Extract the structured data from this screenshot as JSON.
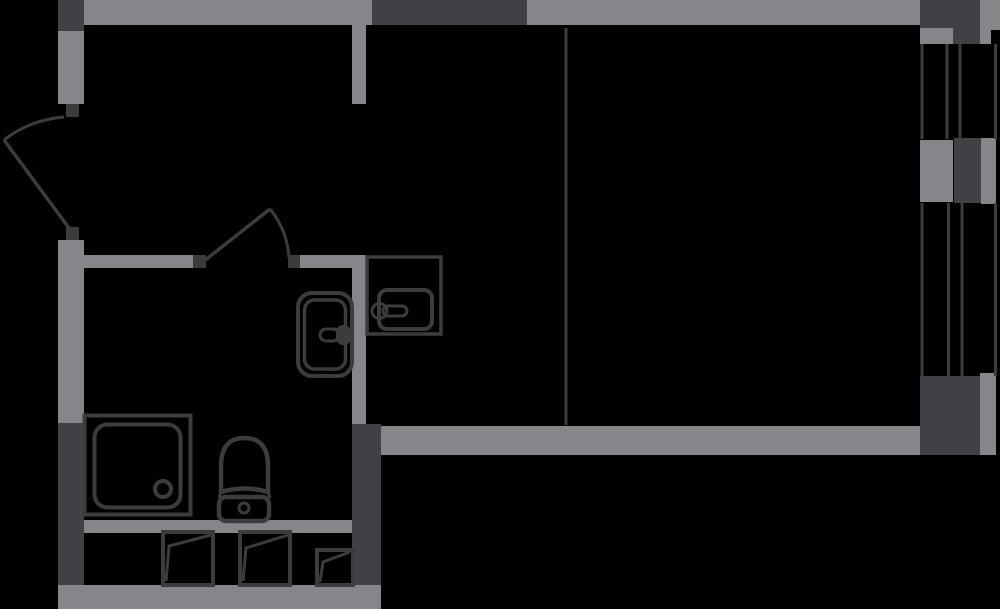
{
  "canvas": {
    "width": 1000,
    "height": 609,
    "background": "#000000"
  },
  "colors": {
    "wall": "#84868A",
    "column": "#404144",
    "line": "#3B3C3E"
  },
  "plan": {
    "walls": [
      {
        "name": "top-exterior-wall",
        "x": 84,
        "y": 0,
        "w": 836,
        "h": 25
      },
      {
        "name": "left-wall-upper",
        "x": 58,
        "y": 31,
        "w": 26,
        "h": 73
      },
      {
        "name": "left-wall-middle",
        "x": 58,
        "y": 240,
        "w": 26,
        "h": 183
      },
      {
        "name": "bath-top-wall-left",
        "x": 84,
        "y": 255,
        "w": 109,
        "h": 13
      },
      {
        "name": "bath-top-wall-right",
        "x": 300,
        "y": 255,
        "w": 66,
        "h": 13
      },
      {
        "name": "divider-wall-stub",
        "x": 352,
        "y": 25,
        "w": 14,
        "h": 79
      },
      {
        "name": "divider-wall",
        "x": 352,
        "y": 255,
        "w": 14,
        "h": 170
      },
      {
        "name": "bath-bottom-wall",
        "x": 84,
        "y": 520,
        "w": 268,
        "h": 13
      },
      {
        "name": "bottom-exterior-wall",
        "x": 58,
        "y": 585,
        "w": 323,
        "h": 24
      },
      {
        "name": "living-bottom-wall",
        "x": 381,
        "y": 426,
        "w": 539,
        "h": 29
      },
      {
        "name": "window-sill-top",
        "x": 920,
        "y": 28,
        "w": 33,
        "h": 16
      },
      {
        "name": "window-pillar-sill",
        "x": 920,
        "y": 140,
        "w": 33,
        "h": 62
      },
      {
        "name": "right-outer-wall-top",
        "x": 980,
        "y": 0,
        "w": 20,
        "h": 44
      },
      {
        "name": "right-outer-wall-mid",
        "x": 981,
        "y": 138,
        "w": 15,
        "h": 66
      },
      {
        "name": "right-outer-wall-bottom",
        "x": 980,
        "y": 373,
        "w": 16,
        "h": 82
      }
    ],
    "columns": [
      {
        "name": "corner-column-topleft",
        "x": 58,
        "y": 0,
        "w": 26,
        "h": 31
      },
      {
        "name": "top-wall-dark-section",
        "x": 372,
        "y": 0,
        "w": 155,
        "h": 25
      },
      {
        "name": "right-column-top-inner",
        "x": 920,
        "y": 0,
        "w": 33,
        "h": 28
      },
      {
        "name": "right-column-top-outer",
        "x": 953,
        "y": 0,
        "w": 27,
        "h": 44
      },
      {
        "name": "right-column-mid",
        "x": 954,
        "y": 138,
        "w": 27,
        "h": 65
      },
      {
        "name": "right-column-bottom",
        "x": 920,
        "y": 376,
        "w": 60,
        "h": 79
      },
      {
        "name": "left-column-bottom",
        "x": 58,
        "y": 423,
        "w": 26,
        "h": 162
      },
      {
        "name": "bath-corner-column",
        "x": 352,
        "y": 424,
        "w": 29,
        "h": 161
      }
    ],
    "notches": [
      {
        "name": "right-outer-notch",
        "x": 991,
        "y": 30,
        "w": 9,
        "h": 14
      }
    ],
    "door_jambs": [
      {
        "name": "entry-door-jamb-top",
        "x": 66,
        "y": 104,
        "w": 13,
        "h": 13
      },
      {
        "name": "entry-door-jamb-bottom",
        "x": 66,
        "y": 227,
        "w": 13,
        "h": 13
      },
      {
        "name": "bath-door-jamb-left",
        "x": 193,
        "y": 255,
        "w": 13,
        "h": 13
      },
      {
        "name": "bath-door-jamb-right",
        "x": 288,
        "y": 255,
        "w": 12,
        "h": 13
      }
    ],
    "partition_lines": [
      {
        "name": "kitchen-partition-line",
        "x": 564.5,
        "y": 28,
        "w": 3,
        "h": 397
      }
    ],
    "window_mullions": [
      {
        "name": "window-line",
        "x": 920.5,
        "y": 44,
        "w": 3,
        "h": 95
      },
      {
        "name": "window-line",
        "x": 945.5,
        "y": 44,
        "w": 3,
        "h": 95
      },
      {
        "name": "window-line",
        "x": 958.5,
        "y": 44,
        "w": 3,
        "h": 95
      },
      {
        "name": "window-line",
        "x": 994,
        "y": 44,
        "w": 3,
        "h": 95
      },
      {
        "name": "window-line",
        "x": 920.5,
        "y": 203,
        "w": 3,
        "h": 173
      },
      {
        "name": "window-line",
        "x": 947,
        "y": 203,
        "w": 3,
        "h": 173
      },
      {
        "name": "window-line",
        "x": 960.5,
        "y": 203,
        "w": 3,
        "h": 173
      },
      {
        "name": "window-line",
        "x": 994,
        "y": 203,
        "w": 3,
        "h": 173
      }
    ],
    "doors": [
      {
        "name": "entry-door",
        "leaf": [
          4,
          140,
          69,
          228
        ],
        "swing_arc": "M 64 117 A 112 112 0 0 0 4 140"
      },
      {
        "name": "bathroom-door",
        "leaf": [
          204,
          261,
          270,
          209
        ],
        "swing_arc": "M 270 209 A 86 86 0 0 1 289 258"
      }
    ],
    "fixtures": [
      {
        "name": "shower-tray",
        "shapes": [
          {
            "t": "rect",
            "x": 84.5,
            "y": 415.5,
            "w": 106,
            "h": 99,
            "sw": 4
          },
          {
            "t": "rect",
            "x": 94.5,
            "y": 424.5,
            "w": 86,
            "h": 83,
            "r": 13,
            "sw": 4
          },
          {
            "t": "circle",
            "cx": 163,
            "cy": 489,
            "r": 8,
            "sw": 4
          }
        ]
      },
      {
        "name": "toilet",
        "shapes": [
          {
            "t": "path",
            "d": "M 221 492 L 221 466 Q 221 438 244.5 438 Q 268 438 268 466 L 268 492 Q 244.5 485 221 492 Z",
            "sw": 4.5
          },
          {
            "t": "line",
            "x1": 222,
            "y1": 489,
            "x2": 219,
            "y2": 498,
            "sw": 3
          },
          {
            "t": "line",
            "x1": 267,
            "y1": 489,
            "x2": 270,
            "y2": 498,
            "sw": 3
          },
          {
            "t": "rect",
            "x": 219,
            "y": 497,
            "w": 50,
            "h": 24,
            "r": 7,
            "sw": 4.5
          },
          {
            "t": "circle",
            "cx": 244,
            "cy": 508,
            "r": 5,
            "sw": 3
          }
        ]
      },
      {
        "name": "washbasin",
        "shapes": [
          {
            "t": "rect",
            "x": 298,
            "y": 293,
            "w": 54,
            "h": 83,
            "r": 14,
            "sw": 4
          },
          {
            "t": "rect",
            "x": 304.5,
            "y": 300,
            "w": 41,
            "h": 69,
            "r": 10,
            "sw": 3.5
          },
          {
            "t": "rect",
            "x": 336,
            "y": 325,
            "w": 15,
            "h": 20,
            "r": 7,
            "f": 1
          },
          {
            "t": "rect",
            "x": 320,
            "y": 329,
            "w": 19,
            "h": 12,
            "r": 6,
            "sw": 3
          }
        ]
      },
      {
        "name": "kitchen-sink",
        "shapes": [
          {
            "t": "rect",
            "x": 367,
            "y": 257,
            "w": 74,
            "h": 77,
            "sw": 3.5
          },
          {
            "t": "rect",
            "x": 379,
            "y": 290,
            "w": 53,
            "h": 39,
            "r": 8,
            "sw": 4
          },
          {
            "t": "circle",
            "cx": 379.5,
            "cy": 311,
            "r": 7.5,
            "sw": 3
          },
          {
            "t": "rect",
            "x": 383,
            "y": 306,
            "w": 24,
            "h": 10,
            "r": 5,
            "sw": 3
          }
        ]
      }
    ],
    "panels": [
      {
        "name": "sash-panel-1",
        "shapes": [
          {
            "t": "rect",
            "x": 163,
            "y": 532,
            "w": 50,
            "h": 53,
            "sw": 4
          },
          {
            "t": "polyline",
            "pts": "211,535 169,546 166,581",
            "sw": 3
          }
        ]
      },
      {
        "name": "sash-panel-2",
        "shapes": [
          {
            "t": "rect",
            "x": 240,
            "y": 532,
            "w": 50,
            "h": 53,
            "sw": 4
          },
          {
            "t": "polyline",
            "pts": "288,535 246,548 243,581",
            "sw": 3
          }
        ]
      },
      {
        "name": "sash-panel-3",
        "shapes": [
          {
            "t": "rect",
            "x": 317,
            "y": 550,
            "w": 36,
            "h": 35,
            "sw": 4
          },
          {
            "t": "polyline",
            "pts": "350,552 323,562 320,582",
            "sw": 3
          }
        ]
      }
    ]
  }
}
